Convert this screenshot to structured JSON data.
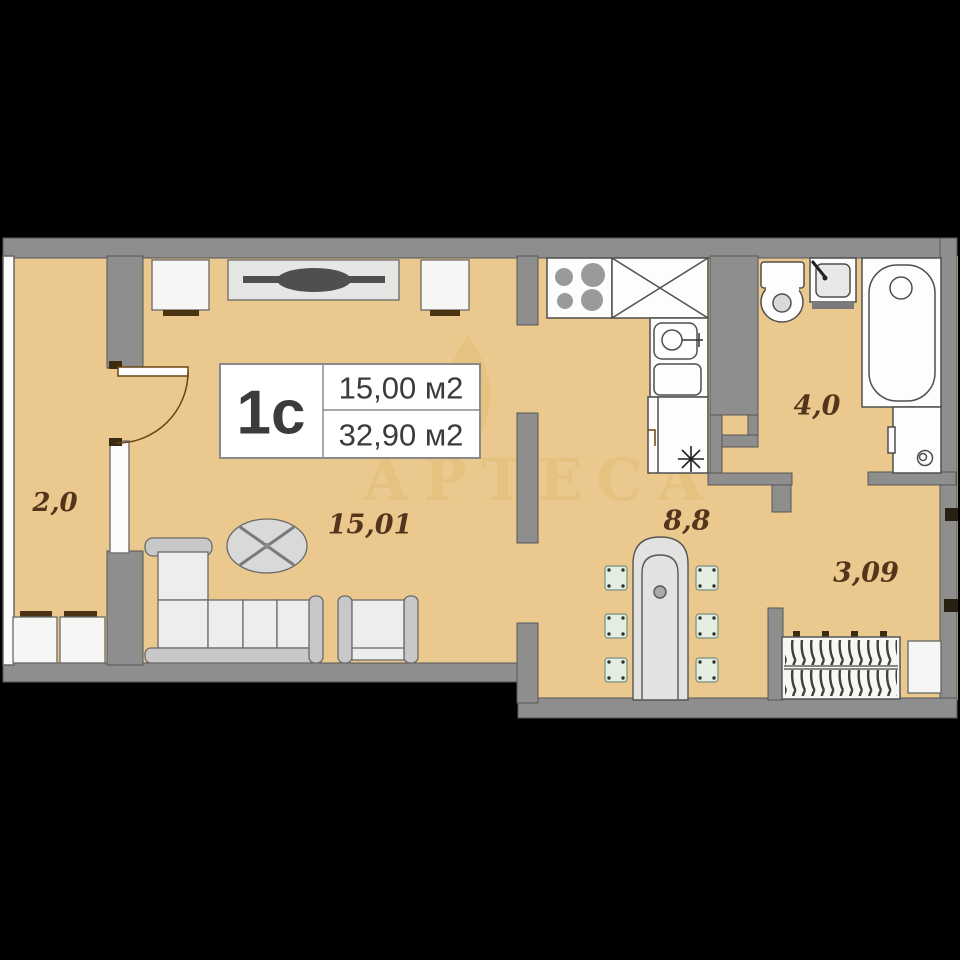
{
  "scene": {
    "background_color": "#000000",
    "floor_color": "#ebc98e",
    "wall_color": "#8e8e8e"
  },
  "info_box": {
    "unit_label": "1с",
    "room_area": "15,00 м2",
    "total_area": "32,90 м2"
  },
  "room_labels": {
    "balcony": "2,0",
    "living_room": "15,01",
    "hallway": "8,8",
    "bathroom": "4,0",
    "entry": "3,09"
  },
  "watermark": {
    "text": "АРТЕСА",
    "color": "#c79a2a"
  }
}
